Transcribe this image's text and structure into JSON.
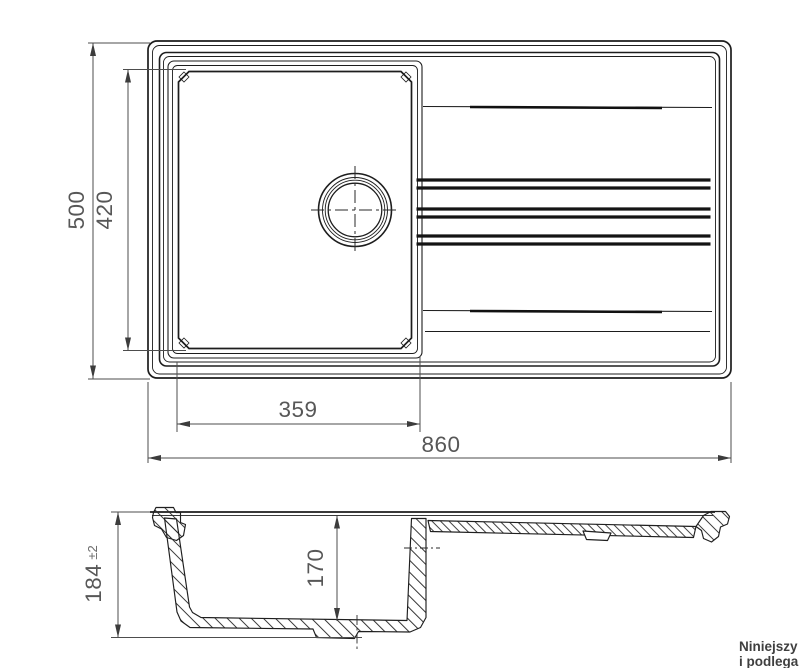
{
  "top_view": {
    "overall_width_mm": "860",
    "overall_depth_mm": "500",
    "basin_width_mm": "359",
    "basin_depth_mm": "420"
  },
  "section_view": {
    "overall_height_mm": "184",
    "height_tolerance": "±2",
    "basin_inner_depth_mm": "170"
  },
  "footnote": {
    "line1": "Niniejszy",
    "line2": "i podlega"
  },
  "colors": {
    "drawing_line": "#1d1d1d",
    "dimension_line": "#4d4d4d",
    "background": "#ffffff"
  }
}
